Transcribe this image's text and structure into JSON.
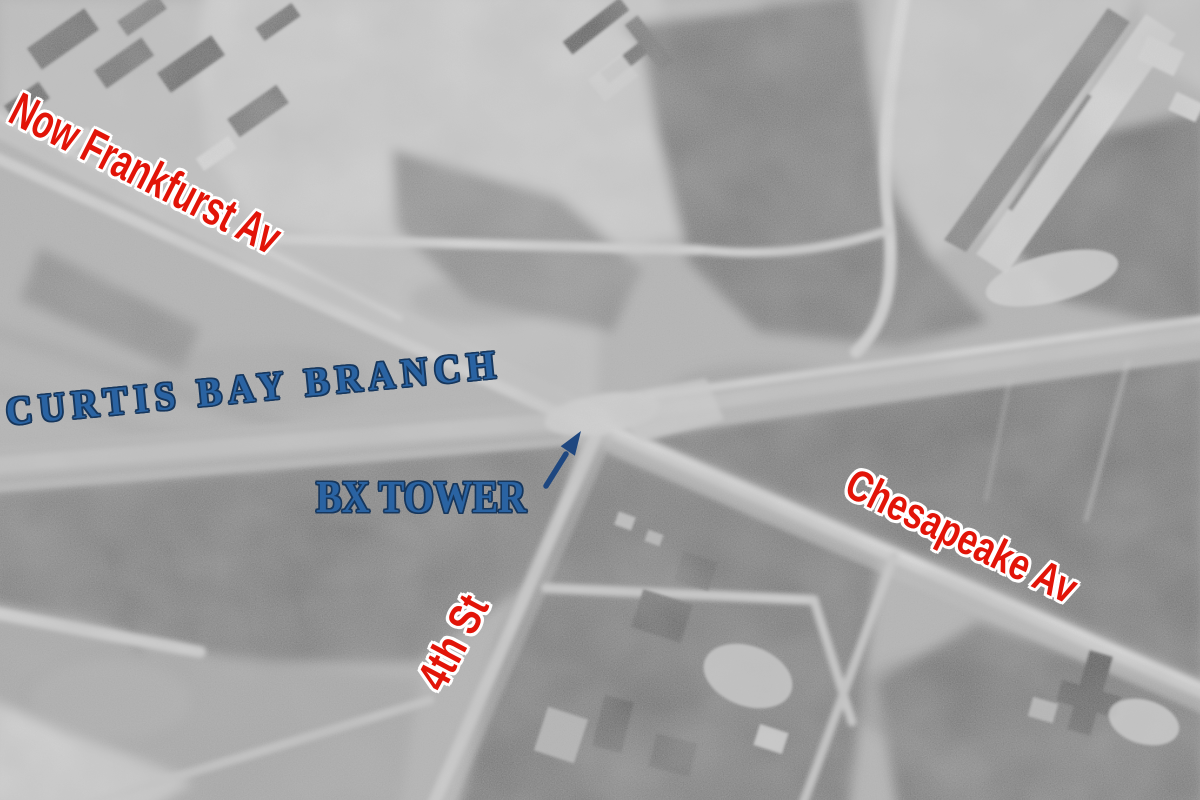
{
  "annotations": {
    "frankfurst_av": {
      "label": "Now Frankfurst Av",
      "color": "#e21408"
    },
    "curtis_bay_branch": {
      "label": "CURTIS BAY BRANCH",
      "color": "#2a63a2"
    },
    "bx_tower": {
      "label": "BX TOWER",
      "color": "#2a63a2",
      "icon": "arrow-up-right-icon"
    },
    "chesapeake_av": {
      "label": "Chesapeake Av",
      "color": "#e21408"
    },
    "fourth_st": {
      "label": "4th St",
      "color": "#e21408"
    }
  },
  "palette": {
    "annotation_red": "#e21408",
    "annotation_blue": "#2a63a2",
    "label_outline_white": "#ffffff",
    "arrow_blue": "#1e4780",
    "photo_base_gray": "#b0b0b0"
  }
}
